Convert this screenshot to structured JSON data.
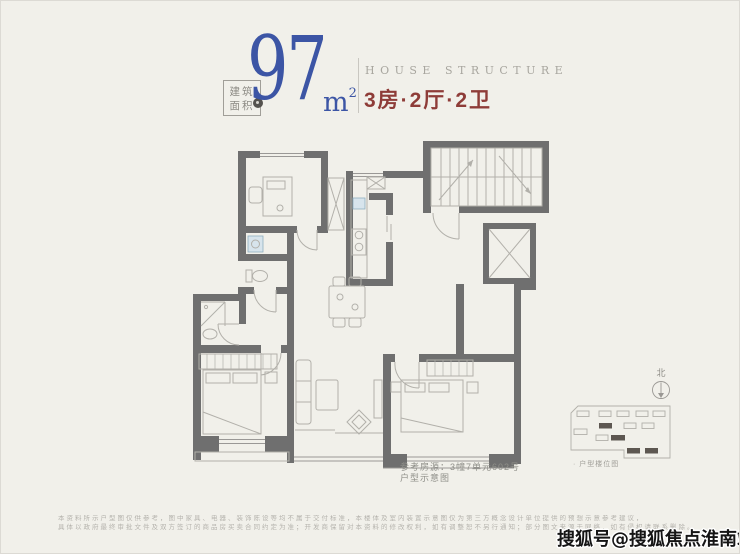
{
  "colors": {
    "background": "#f1f0ea",
    "accent_blue": "#3c55a5",
    "accent_red": "#8e3c38",
    "wall_gray": "#6f6f6f",
    "furniture_line": "#b2b0aa",
    "text_gray": "#8d8b85",
    "fixture_blue": "#d7e4ec",
    "site_building_fill": "#5d5751"
  },
  "header": {
    "area_badge_line1": "建筑",
    "area_badge_line2": "面积",
    "area_value": "97",
    "area_unit": "m",
    "area_unit_sup": "2",
    "subtitle_en": "HOUSE STRUCTURE",
    "layout_cn": "3房·2厅·2卫"
  },
  "plan": {
    "caption_line1": "参考房源：3幢7单元602号",
    "caption_line2": "户型示意图"
  },
  "siteplan": {
    "north_label": "北",
    "caption": "· 户型楼位图"
  },
  "watermark": {
    "text": "搜狐号@搜狐焦点淮南站"
  },
  "disclaimer": {
    "line1": "本资料所示户型图仅供参考，图中家具、电器、装饰陈设等均不属于交付标准，本楼体及室内装置示意图仅为第三方概念设计单位提供的预想示意参考建议，",
    "line2": "具体以政府最终审批文件及双方签订的商品房买卖合同约定为准；开发商保留对本资料的修改权利，如有调整恕不另行通知；部分图文来源于网络，如有侵权请联系删除。"
  }
}
